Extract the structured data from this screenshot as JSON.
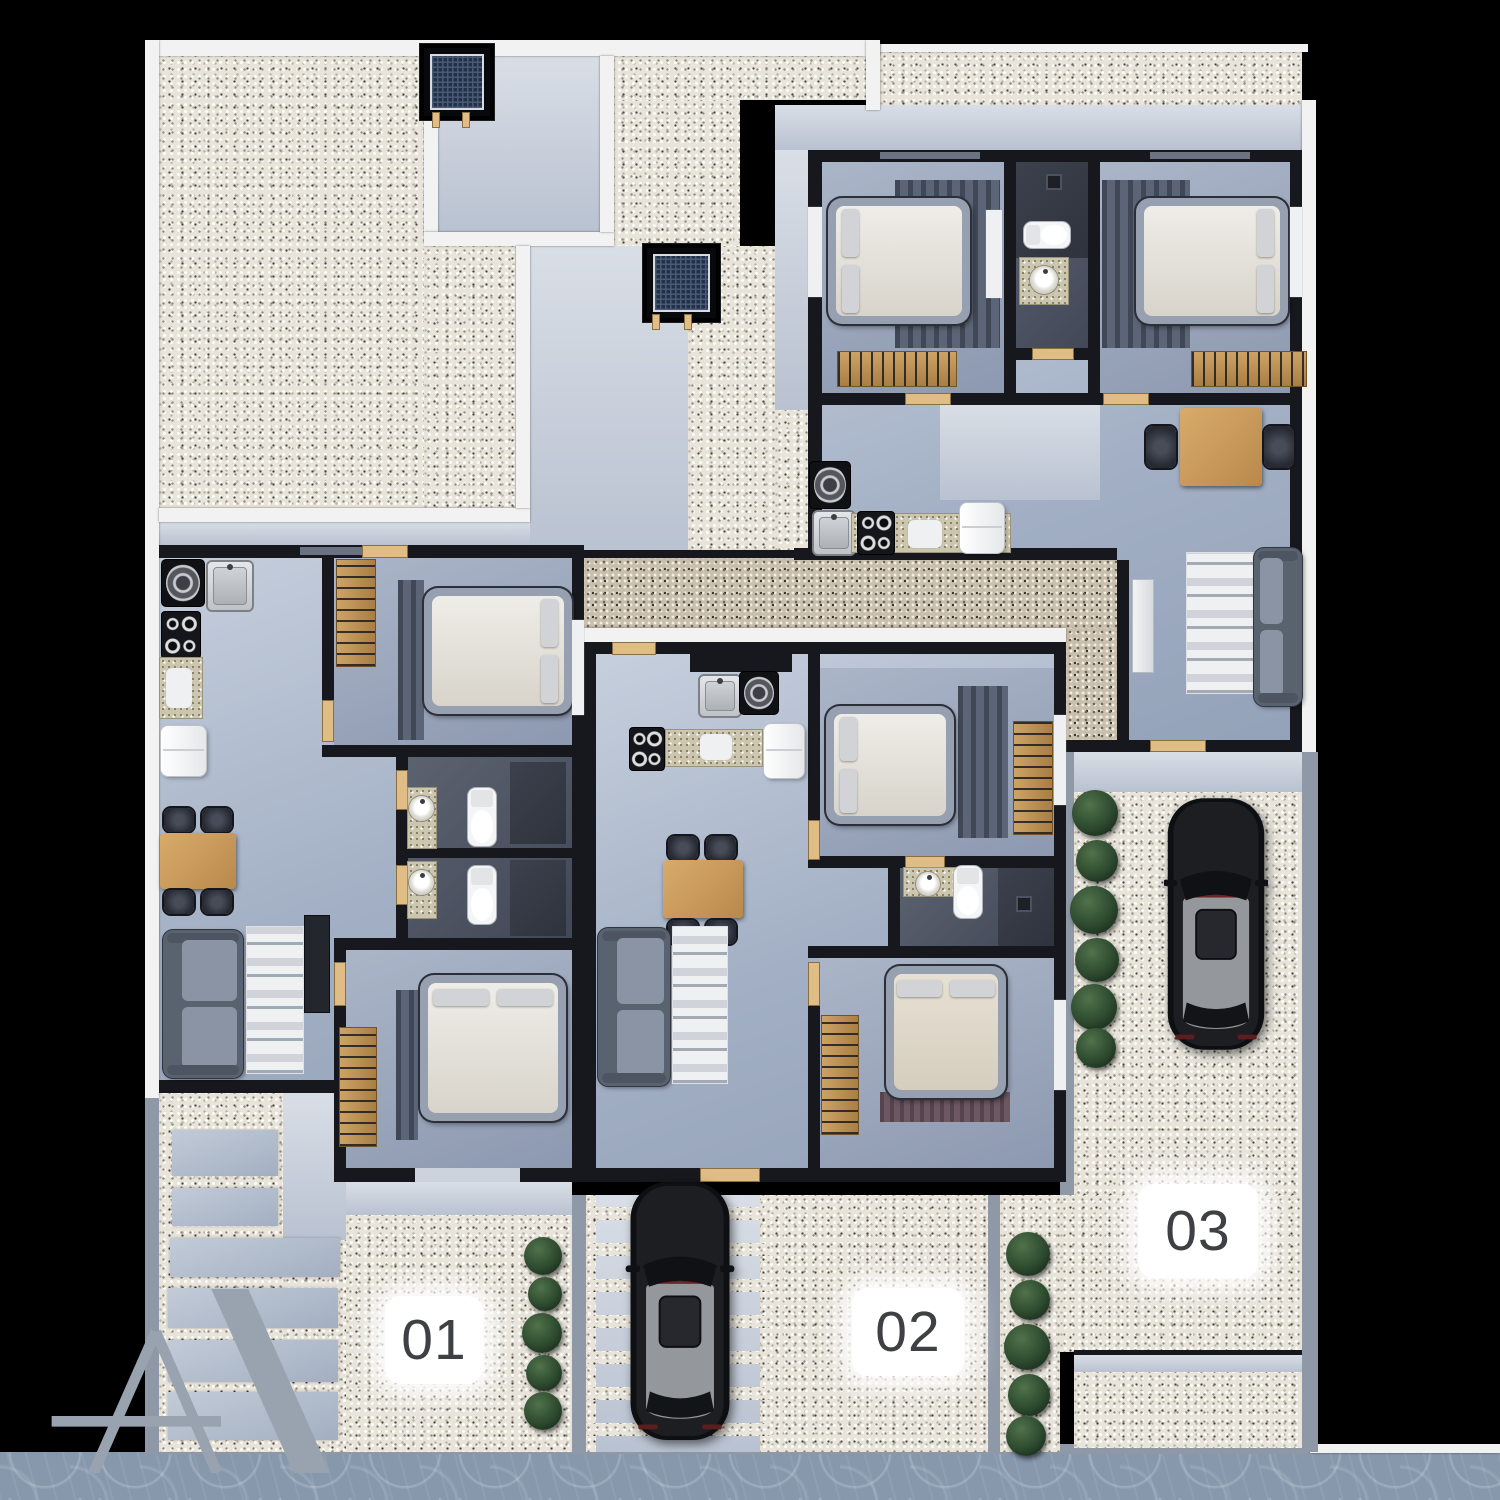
{
  "scene": {
    "description": "Top-down 3D architectural floor plan render of three apartment units with gardens and parking",
    "background": "#000000",
    "units": [
      {
        "id": "unit-01",
        "label": "01"
      },
      {
        "id": "unit-02",
        "label": "02"
      },
      {
        "id": "unit-03",
        "label": "03"
      }
    ],
    "logo": {
      "letter": "A",
      "color": "#99a3af"
    }
  },
  "palette": {
    "wall_black": "#17181d",
    "wall_white": "#f1f2f1",
    "wall_gray": "#8e98a7",
    "floor_blue": "#a9b4c7",
    "bedroom_floor": "#98a3b8",
    "bathroom_dark": "#49505e",
    "gravel_light": "#e8e4da",
    "gravel_warm": "#c9bfae",
    "wood": "#c2965c",
    "door_wood": "#e0bd85",
    "sofa_gray": "#59626f",
    "rug_white": "#eef0f2",
    "bed_white": "#ece9e3",
    "bed_cream": "#e2dccd",
    "car_black": "#141518",
    "plant_green": "#2f4a30",
    "sidewalk_blue": "#8798ad",
    "label_bg": "#ffffff",
    "label_text": "#3e4044"
  },
  "legend": {
    "elements": [
      "bed",
      "wardrobe",
      "sofa",
      "rug",
      "dining-table",
      "chair",
      "toilet",
      "round-sink",
      "steel-sink",
      "stove",
      "washing-machine",
      "fridge",
      "tv-console",
      "skylight-grate",
      "shrub",
      "car",
      "gravel",
      "paver-slab",
      "sidewalk"
    ]
  }
}
